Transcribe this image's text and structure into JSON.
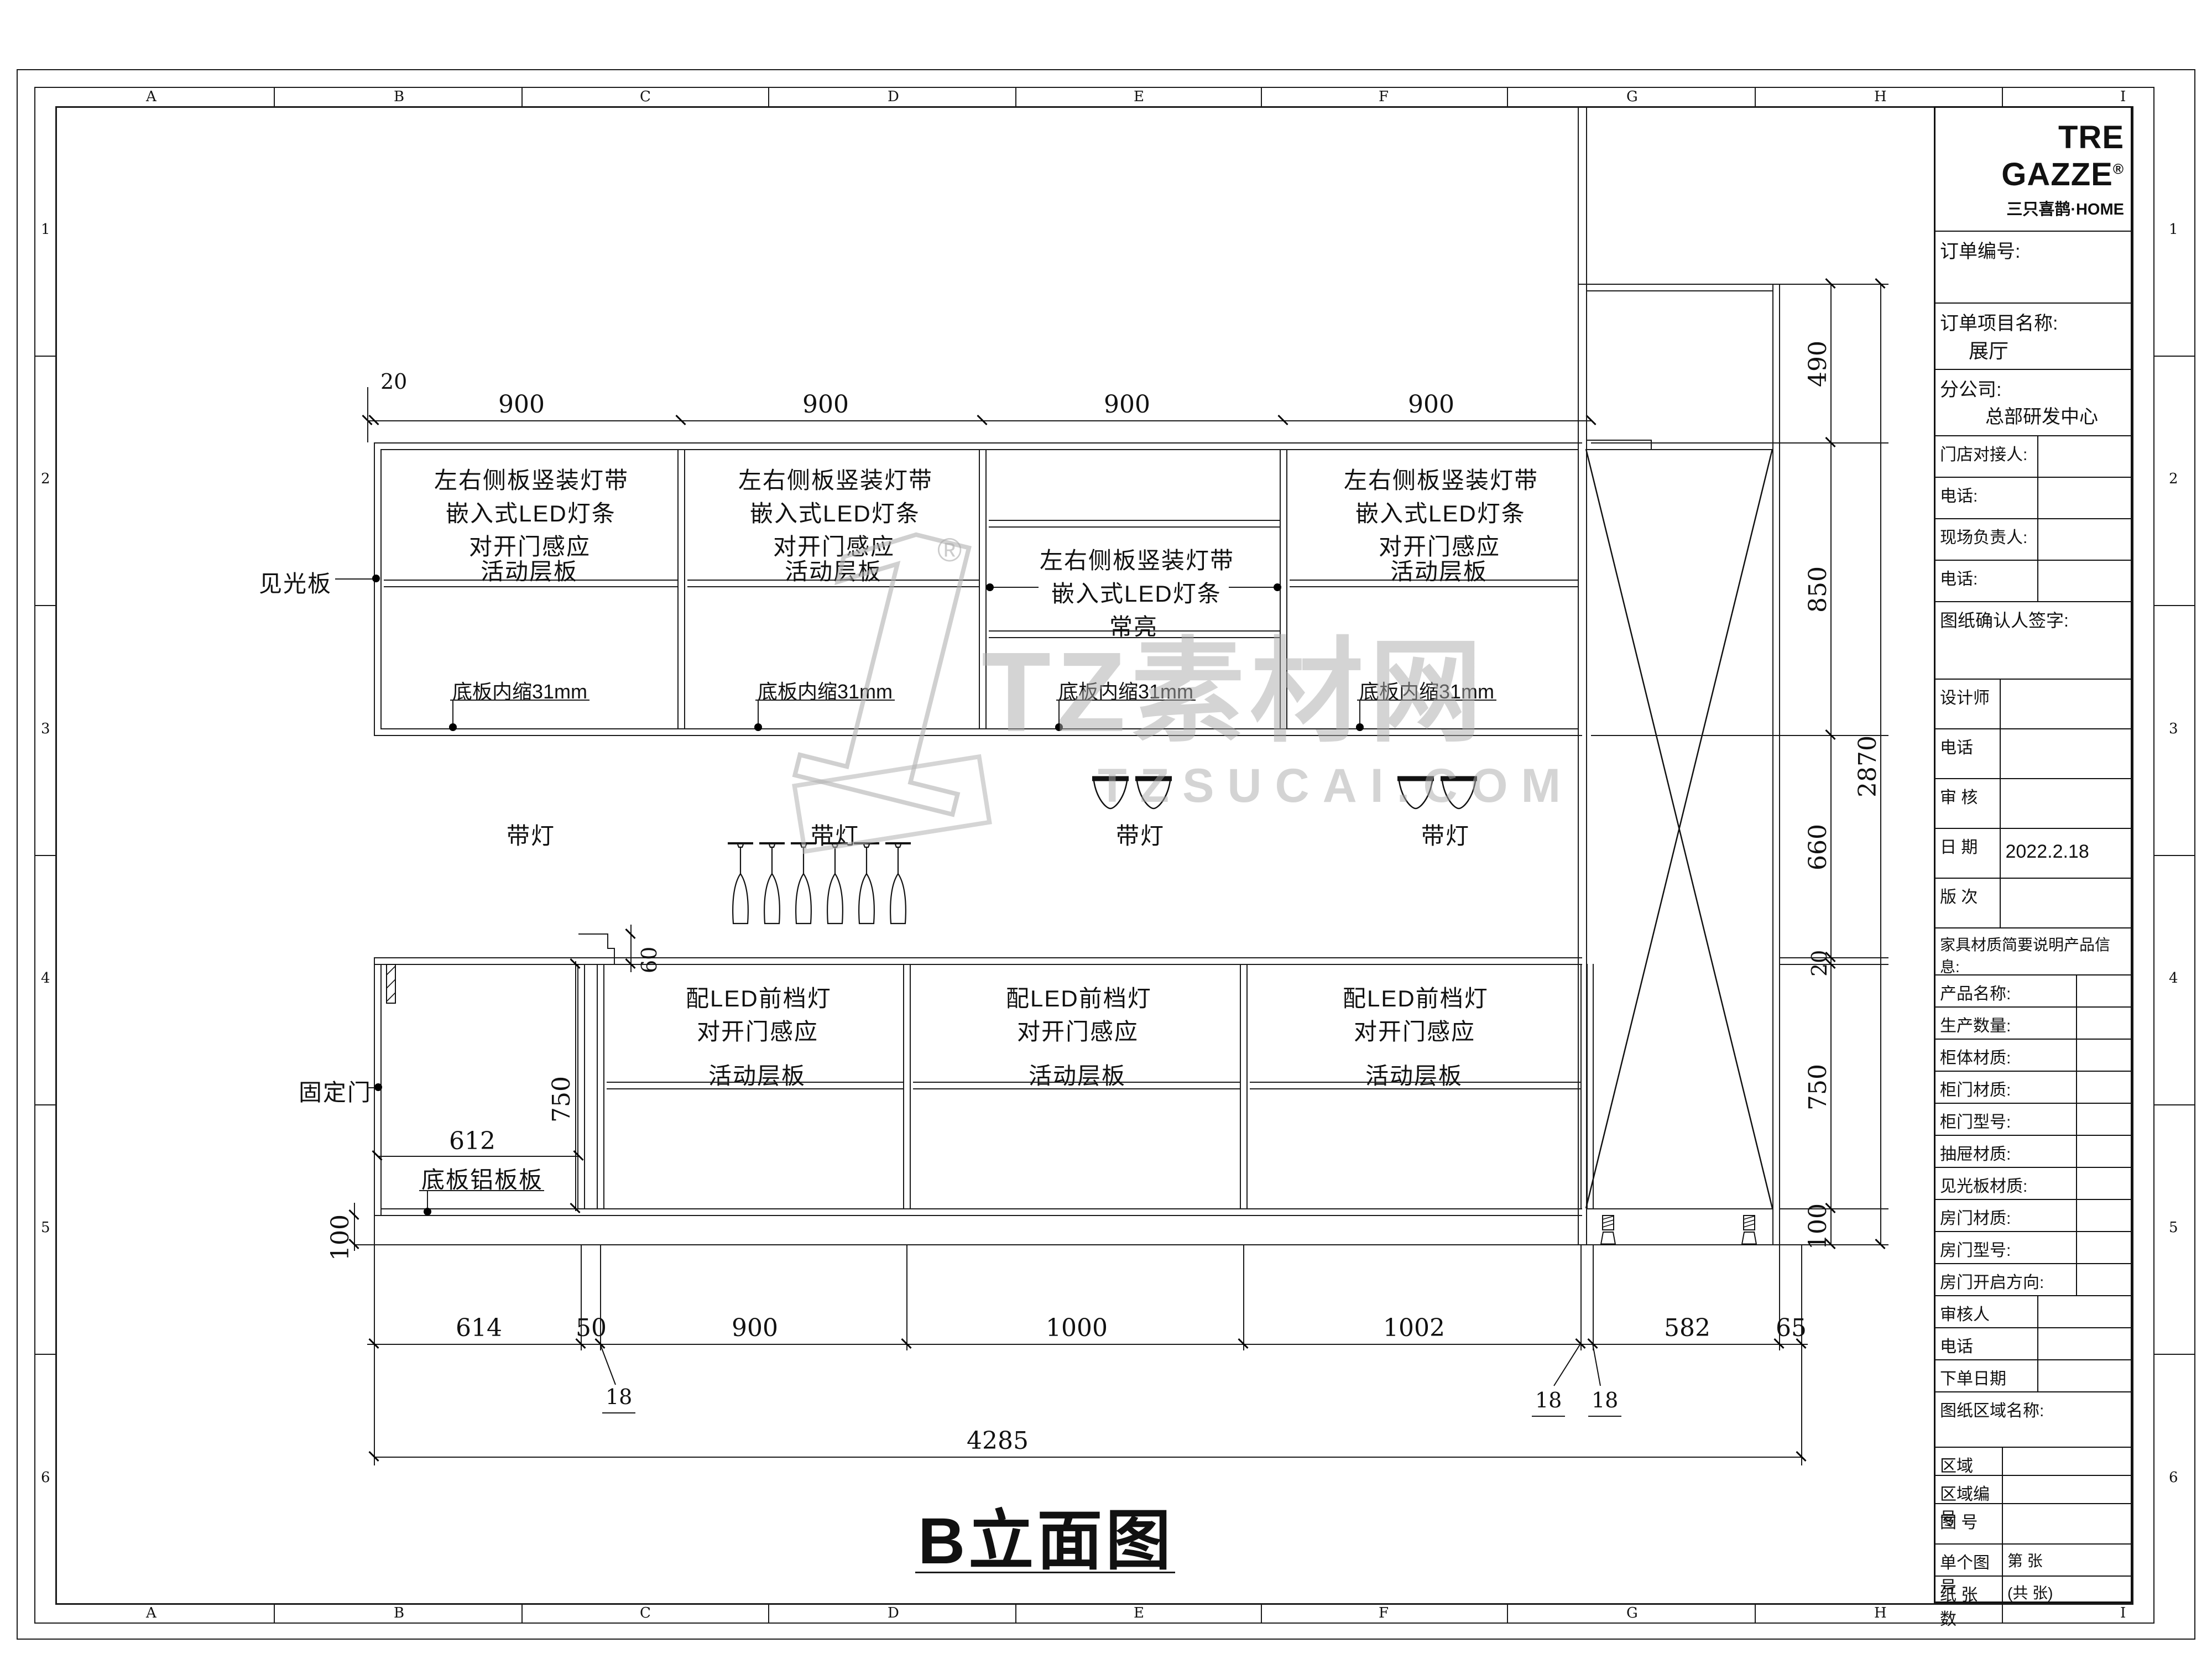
{
  "watermark": {
    "one": "1",
    "reg": "®",
    "brand": "TZ素材网",
    "site": "TZSUCAI.COM"
  },
  "frame": {
    "top_letters": [
      "A",
      "B",
      "C",
      "D",
      "E",
      "F",
      "G",
      "H",
      "I"
    ],
    "side_numbers": [
      "1",
      "2",
      "3",
      "4",
      "5",
      "6"
    ]
  },
  "drawing": {
    "title": "B立面图",
    "top_dims": {
      "offset": "20",
      "s0": "900",
      "s1": "900",
      "s2": "900",
      "s3": "900"
    },
    "upper_sections": [
      {
        "l1": "左右侧板竖装灯带",
        "l2": "嵌入式LED灯条",
        "l3": "对开门感应",
        "shelf": "活动层板",
        "note": "底板内缩31mm"
      },
      {
        "l1": "左右侧板竖装灯带",
        "l2": "嵌入式LED灯条",
        "l3": "对开门感应",
        "shelf": "活动层板",
        "note": "底板内缩31mm"
      },
      {
        "l1": "左右侧板竖装灯带",
        "l2": "嵌入式LED灯条",
        "l3": "常亮",
        "note": "底板内缩31mm"
      },
      {
        "l1": "左右侧板竖装灯带",
        "l2": "嵌入式LED灯条",
        "l3": "对开门感应",
        "shelf": "活动层板",
        "note": "底板内缩31mm"
      }
    ],
    "labels": {
      "jgb": "见光板",
      "gdm": "固定门",
      "dbl": "底板铝板板",
      "dd": "带灯",
      "step": "60",
      "inner": "612"
    },
    "lower_sections": [
      {
        "l1": "配LED前档灯",
        "l2": "对开门感应",
        "shelf": "活动层板"
      },
      {
        "l1": "配LED前档灯",
        "l2": "对开门感应",
        "shelf": "活动层板"
      },
      {
        "l1": "配LED前档灯",
        "l2": "对开门感应",
        "shelf": "活动层板"
      }
    ],
    "left_dims": {
      "h750": "750",
      "h100": "100"
    },
    "right_dims": {
      "d490": "490",
      "d850": "850",
      "d660": "660",
      "d20": "20",
      "d750": "750",
      "d100": "100",
      "total": "2870",
      "r100": "100"
    },
    "bottom_dims": {
      "d614": "614",
      "d50": "50",
      "d900": "900",
      "d1000": "1000",
      "d1002": "1002",
      "d582": "582",
      "d65": "65",
      "f18a": "18",
      "f18b": "18",
      "f18c": "18",
      "total": "4285"
    }
  },
  "title_block": {
    "logo_main": "TRE GAZZE",
    "logo_reg": "®",
    "logo_sub": "三只喜鹊·HOME",
    "order_no": "订单编号:",
    "project_label": "订单项目名称:",
    "project_value": "展厅",
    "branch_label": "分公司:",
    "branch_value": "总部研发中心",
    "store_contact": "门店对接人:",
    "phone1": "电话:",
    "site_manager": "现场负责人:",
    "phone2": "电话:",
    "sign": "图纸确认人签字:",
    "designer": "设计师",
    "phone3": "电话",
    "review": "审  核",
    "date_label": "日  期",
    "date_value": "2022.2.18",
    "version": "版  次",
    "materials_header": "家具材质简要说明产品信息:",
    "m0": "产品名称:",
    "m1": "生产数量:",
    "m2": "柜体材质:",
    "m3": "柜门材质:",
    "m4": "柜门型号:",
    "m5": "抽屉材质:",
    "m6": "见光板材质:",
    "m7": "房门材质:",
    "m8": "房门型号:",
    "m9": "房门开启方向:",
    "reviewer": "审核人",
    "phone4": "电话",
    "order_date": "下单日期",
    "area_name": "图纸区域名称:",
    "zone": "区域",
    "zone_no": "区域编号",
    "fig_no": "图  号",
    "single_label": "单个图号",
    "single_value": "第    张",
    "sheets_label": "纸 张 数",
    "sheets_value": "(共    张)"
  }
}
